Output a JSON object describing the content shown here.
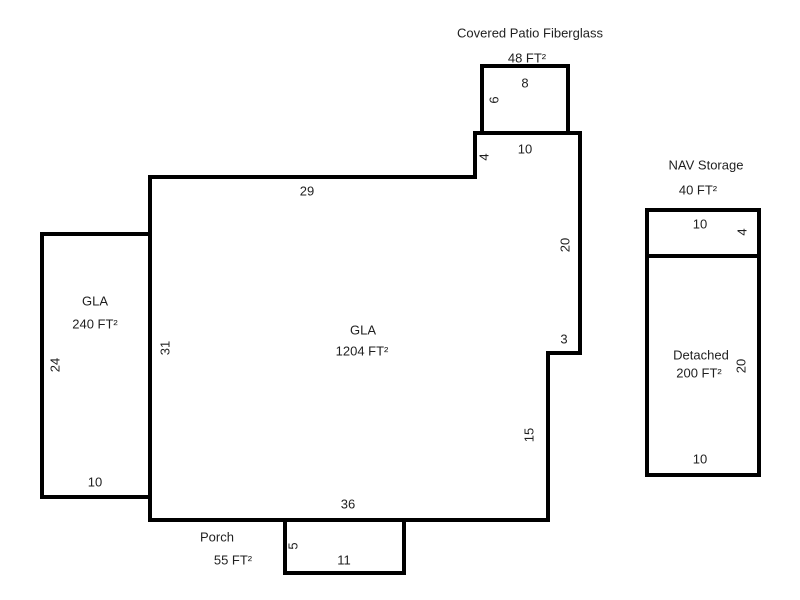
{
  "figure": {
    "type": "floor-plan-sketch",
    "units": "FT",
    "colors": {
      "outline": "#000000",
      "background": "#ffffff",
      "text": "#1f1f1f"
    },
    "areas": {
      "covered_patio": {
        "title": "Covered Patio Fiberglass",
        "area": "48 FT²",
        "dims": {
          "top": "8",
          "left": "6"
        }
      },
      "main_gla": {
        "label": "GLA",
        "area": "1204 FT²",
        "dims": {
          "top": "29",
          "notch_left": "4",
          "notch_top": "10",
          "right_upper": "20",
          "step": "3",
          "right_lower": "15",
          "bottom": "36",
          "left": "31"
        }
      },
      "left_gla": {
        "label": "GLA",
        "area": "240 FT²",
        "dims": {
          "left": "24",
          "bottom": "10"
        }
      },
      "nav_storage": {
        "title": "NAV Storage",
        "area": "40 FT²",
        "dims": {
          "top": "10",
          "right": "4"
        }
      },
      "detached": {
        "label": "Detached",
        "area": "200 FT²",
        "dims": {
          "right": "20",
          "bottom": "10"
        }
      },
      "porch": {
        "title": "Porch",
        "area": "55 FT²",
        "dims": {
          "left": "5",
          "bottom": "11"
        }
      }
    }
  }
}
